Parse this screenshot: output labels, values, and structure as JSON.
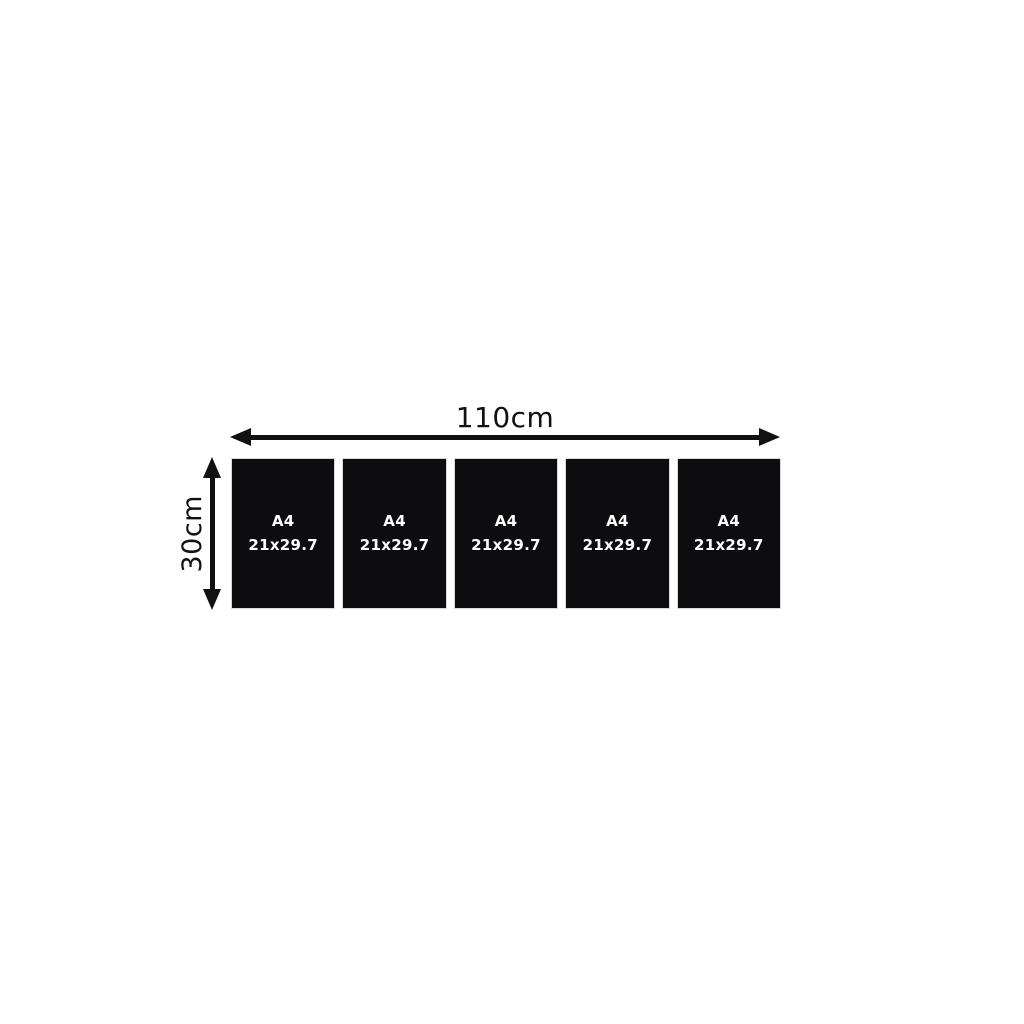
{
  "diagram": {
    "title": "panel-set-dimensions",
    "width_label": "110cm",
    "height_label": "30cm",
    "panels": [
      {
        "name": "A4",
        "size": "21x29.7"
      },
      {
        "name": "A4",
        "size": "21x29.7"
      },
      {
        "name": "A4",
        "size": "21x29.7"
      },
      {
        "name": "A4",
        "size": "21x29.7"
      },
      {
        "name": "A4",
        "size": "21x29.7"
      }
    ],
    "panel_count": 5
  },
  "colors": {
    "background": "#ffffff",
    "panel": "#0d0d10",
    "panel_text": "#ffffff",
    "arrow": "#111111",
    "dimension_text": "#111111"
  }
}
